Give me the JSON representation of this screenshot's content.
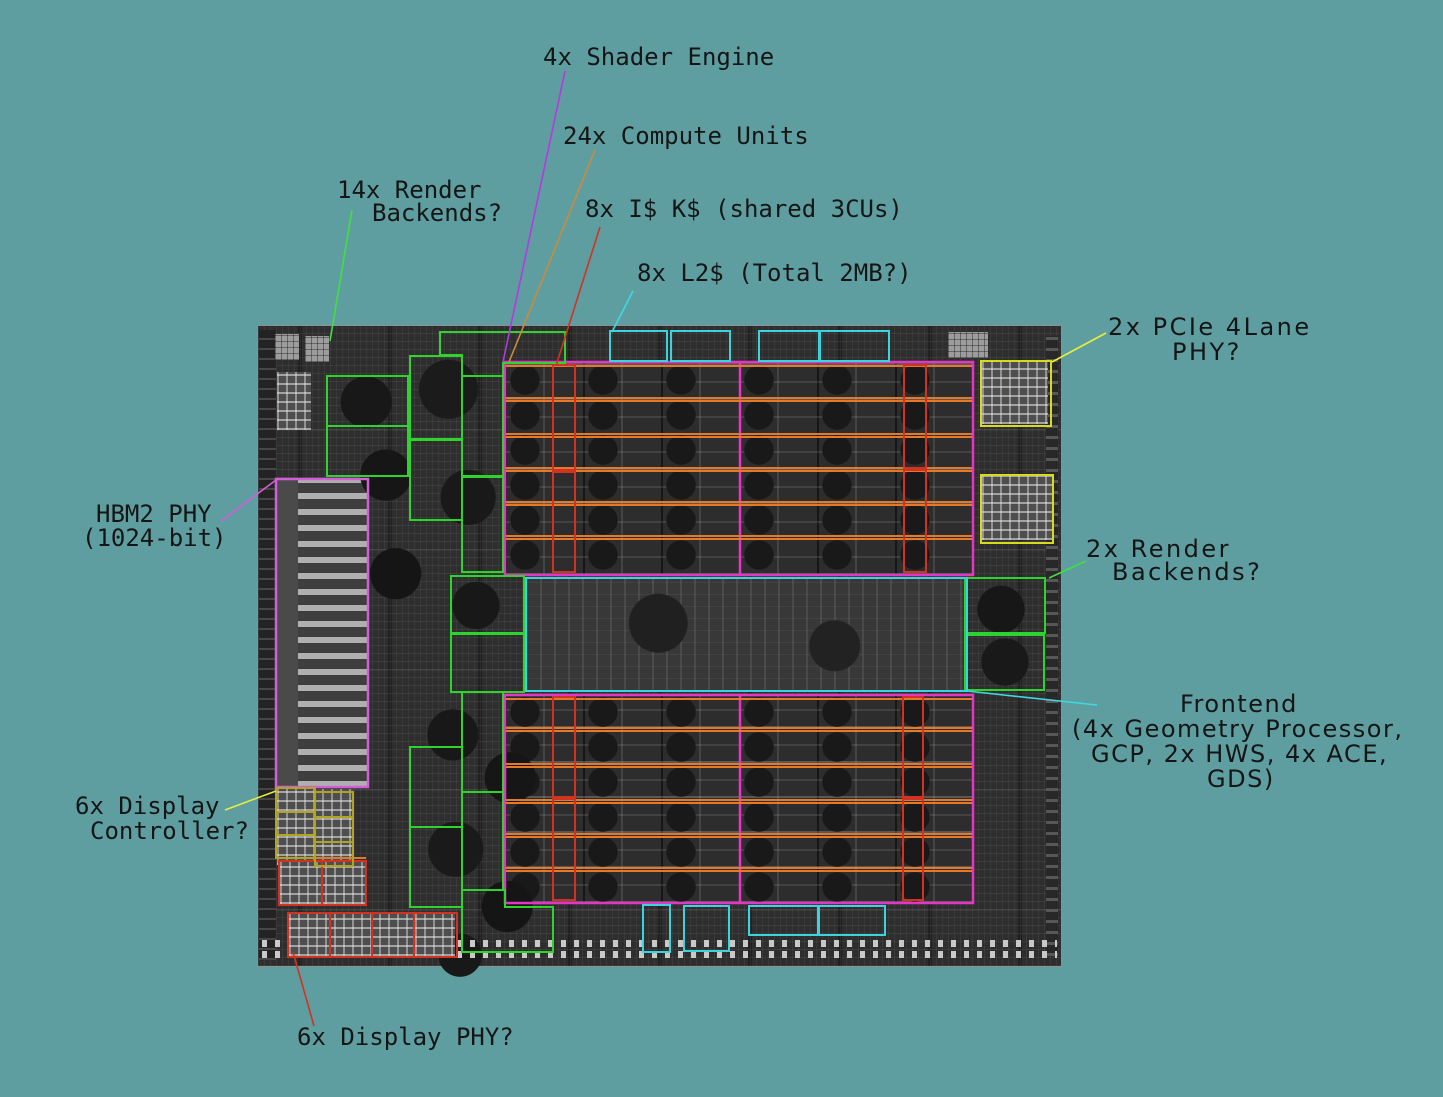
{
  "background_color": "#5f9ea0",
  "die": {
    "kind": "GPU die photograph (grayscale)"
  },
  "labels": {
    "shader_engine": {
      "text": "4x Shader Engine",
      "annotation_color": "#b33ae0"
    },
    "compute_units": {
      "text": "24x Compute Units",
      "annotation_color": "#cc8a3f"
    },
    "render_backends_14": {
      "line1": "14x Render",
      "line2": "Backends?",
      "annotation_color": "#2ed32e"
    },
    "instruction_cache": {
      "text": "8x I$ K$ (shared 3CUs)",
      "annotation_color": "#d23222"
    },
    "l2_cache": {
      "text": "8x L2$ (Total 2MB?)",
      "annotation_color": "#3bd3de"
    },
    "pcie_phy": {
      "line1": "2x PCIe 4Lane",
      "line2": "PHY?",
      "annotation_color": "#d9d920"
    },
    "render_backends_2": {
      "line1": "2x Render",
      "line2": "Backends?",
      "annotation_color": "#2ed32e"
    },
    "frontend": {
      "line1": "Frontend",
      "line2": "(4x Geometry Processor,",
      "line3": "GCP, 2x HWS, 4x ACE,",
      "line4": "GDS)",
      "annotation_color": "#3bd3de"
    },
    "hbm2_phy": {
      "line1": "HBM2 PHY",
      "line2": "(1024-bit)",
      "annotation_color": "#d05fd8"
    },
    "display_controller": {
      "line1": "6x Display",
      "line2": "Controller?",
      "annotation_color": "#b2a41d"
    },
    "display_phy": {
      "text": "6x Display PHY?",
      "annotation_color": "#d23222"
    }
  },
  "overlay_colors": {
    "shader_engine_array": "#e535c5",
    "compute_unit_rows": "#e5792a",
    "instruction_cache_boxes": "#d23222",
    "render_backend_boxes": "#2ed32e",
    "l2_and_frontend_boxes": "#3bd3de",
    "pcie_phy_boxes": "#d9d920",
    "display_controller_boxes": "#b2a41d",
    "display_phy_boxes": "#d23222",
    "hbm2_phy_box": "#d05fd8"
  }
}
